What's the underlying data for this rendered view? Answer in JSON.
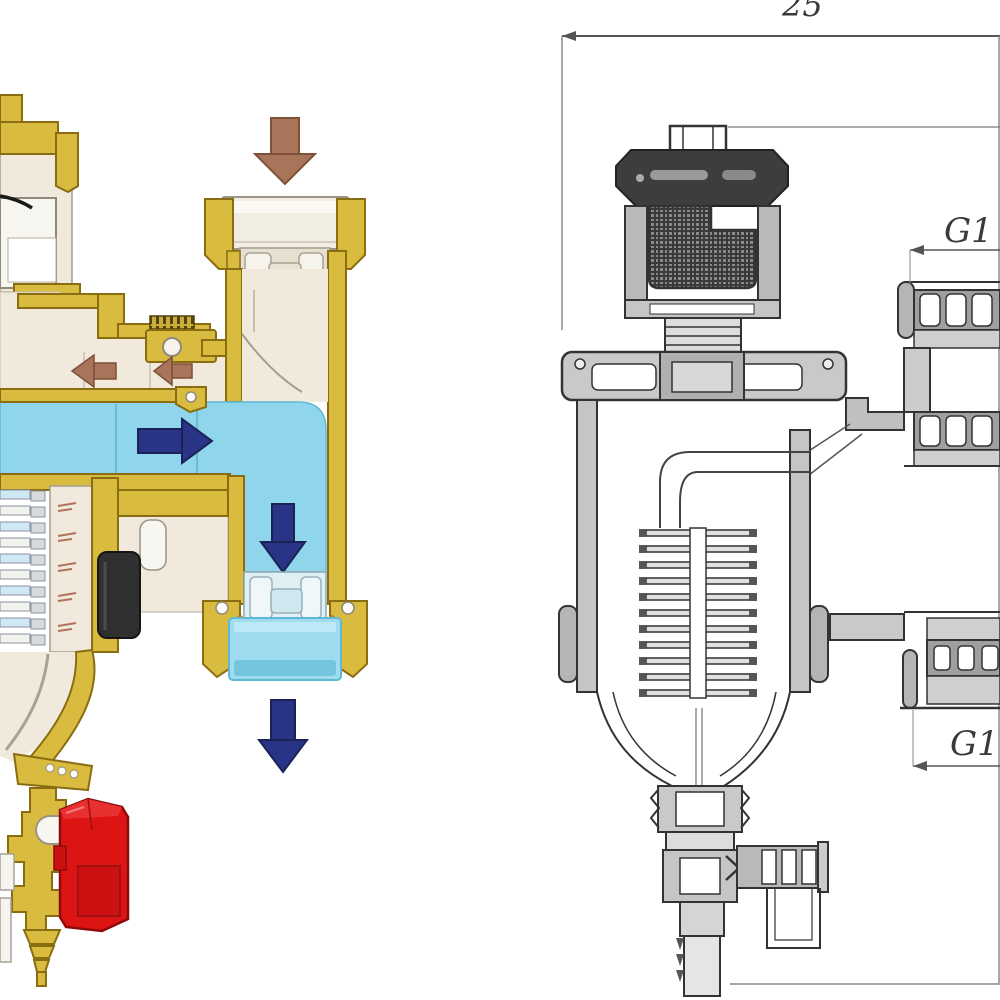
{
  "page": {
    "width": 1000,
    "height": 1000,
    "background": "#ffffff"
  },
  "figure": {
    "type": "technical-illustration",
    "description": "Cutaway rendering (left) and engineering cross-section drawing (right) of a magnetic dirt separator with automatic air vent"
  },
  "left_panel": {
    "name": "colored-cutaway",
    "palette": {
      "brass": "#d9bc3f",
      "brass_outline": "#8a6d10",
      "cream": "#f0e9dc",
      "water_blue": "#8fd6ec",
      "water_blue_deep": "#74c6de",
      "flow_navy": "#2a3487",
      "air_brown": "#a9755a",
      "drain_red": "#dd1414",
      "magnet_black": "#303030"
    },
    "arrows": [
      {
        "name": "inlet-flow-arrow",
        "direction": "down",
        "color": "#a9755a"
      },
      {
        "name": "air-release-arrow-outer",
        "direction": "left",
        "color": "#a9755a"
      },
      {
        "name": "air-release-arrow-inner",
        "direction": "left",
        "color": "#a9755a"
      },
      {
        "name": "water-flow-arrow",
        "direction": "right",
        "color": "#2a3487"
      },
      {
        "name": "downpipe-flow-arrow",
        "direction": "down",
        "color": "#2a3487"
      },
      {
        "name": "outlet-flow-arrow",
        "direction": "down",
        "color": "#2a3487"
      }
    ],
    "components": [
      "automatic-air-vent",
      "inlet-union",
      "water-channel",
      "separator-element",
      "magnet",
      "collection-bowl",
      "outlet-union",
      "drain-valve-red-handle",
      "hose-barb"
    ]
  },
  "right_panel": {
    "name": "engineering-drawing",
    "line_color": "#3a3a3a",
    "labels": {
      "top_dimension": "25",
      "upper_port": "G1",
      "lower_port": "G1"
    },
    "components": [
      "air-vent-cap",
      "float-crosshatch",
      "body-flange",
      "upper-port-thread",
      "lower-port-thread",
      "separator-element",
      "collection-chamber",
      "drain-valve",
      "hose-spigot",
      "dimension-lines"
    ]
  }
}
